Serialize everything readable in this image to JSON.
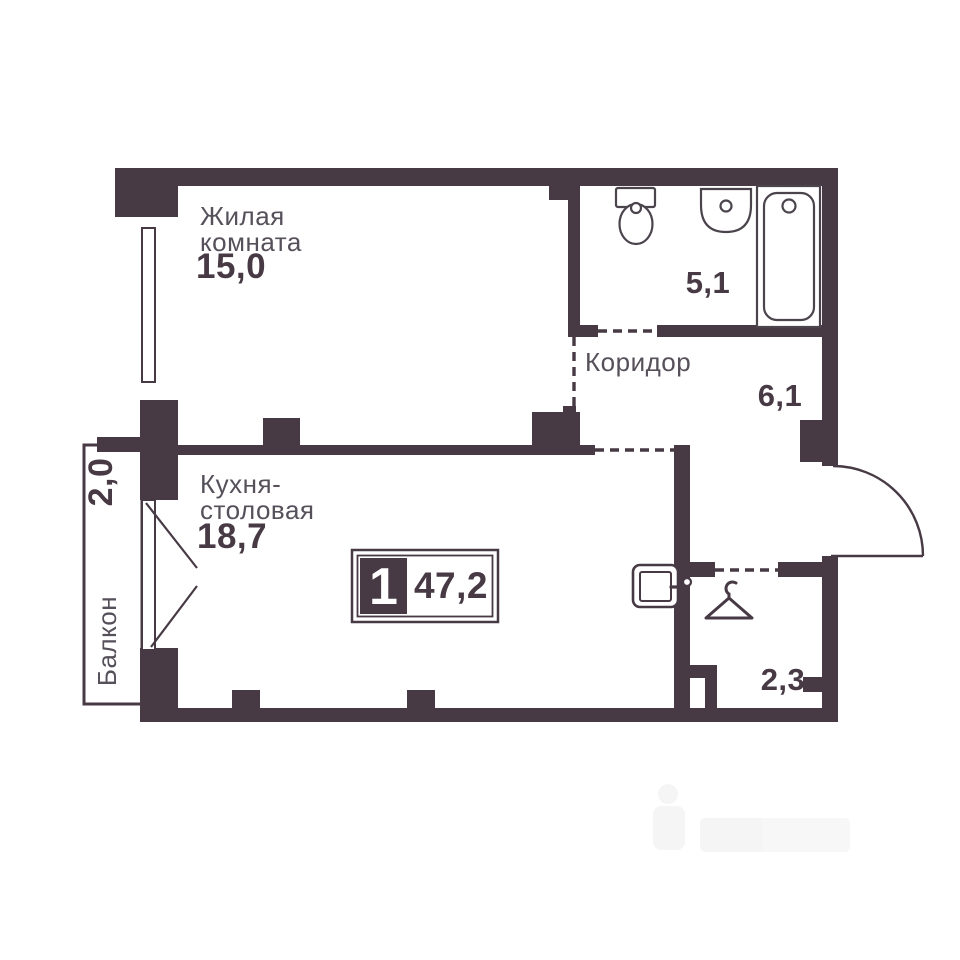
{
  "rooms": {
    "living": {
      "line1": "Жилая",
      "line2": "комната",
      "area": "15,0"
    },
    "bathroom": {
      "area": "5,1"
    },
    "corridor": {
      "name": "Коридор",
      "area": "6,1"
    },
    "kitchen": {
      "line1": "Кухня-",
      "line2": "столовая",
      "area": "18,7"
    },
    "wardrobe": {
      "area": "2,3"
    },
    "balcony": {
      "name": "Балкон",
      "area": "2,0"
    }
  },
  "badge": {
    "rooms": "1",
    "total_area": "47,2"
  },
  "icons": {
    "bathroom": [
      "toilet-icon",
      "sink-icon",
      "bathtub-icon"
    ],
    "kitchen": [
      "electrical-panel-icon",
      "balcony-door-swing"
    ],
    "wardrobe": [
      "hanger-icon"
    ],
    "entrance": [
      "door-swing-arc"
    ]
  },
  "colors": {
    "wall": "#473A44",
    "room_label": "#56505A",
    "area_number": "#473A44",
    "fixture_line": "#4B444D",
    "background": "#FFFFFF"
  }
}
